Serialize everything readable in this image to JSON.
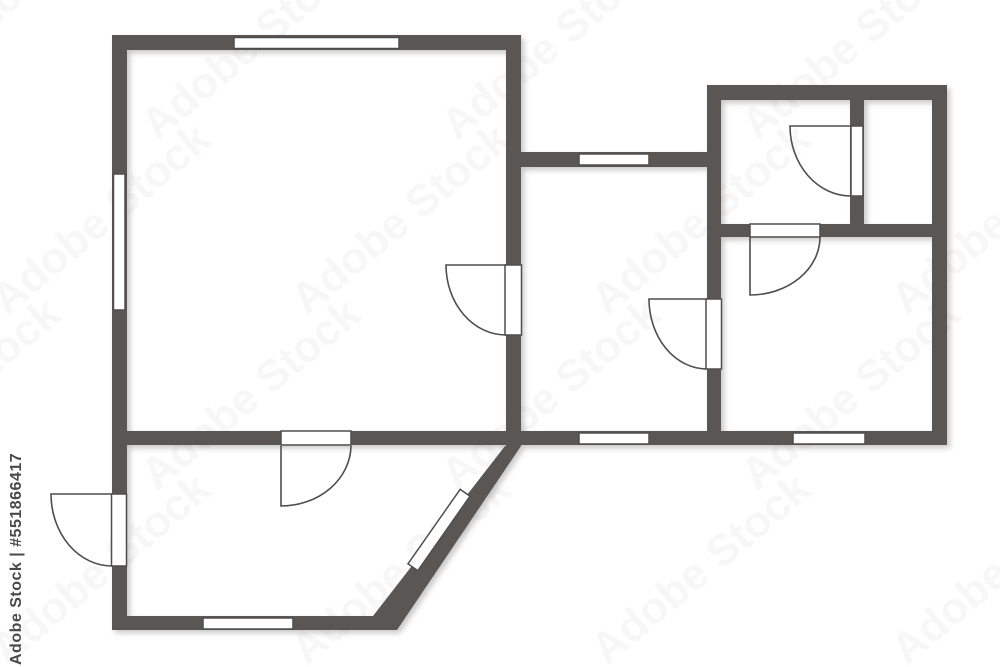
{
  "watermark": {
    "label": "Adobe Stock | #551866417",
    "tile_text": "Adobe Stock",
    "text_color": "#4b4947",
    "tile_color": "#8f8d8b",
    "tile_opacity": 0.06
  },
  "plan": {
    "canvas": {
      "width": 1000,
      "height": 667,
      "background": "#ffffff"
    },
    "wall_color": "#595653",
    "line_color": "#504e4c",
    "window_fill": "#ffffff",
    "walls": [
      {
        "name": "wall-left-exterior",
        "x": 112,
        "y": 35,
        "w": 15,
        "h": 595
      },
      {
        "name": "wall-top-living",
        "x": 112,
        "y": 35,
        "w": 409,
        "h": 15
      },
      {
        "name": "wall-right-living",
        "x": 506,
        "y": 35,
        "w": 15,
        "h": 411
      },
      {
        "name": "wall-bottom-main",
        "x": 112,
        "y": 431,
        "w": 835,
        "h": 14
      },
      {
        "name": "wall-top-middle",
        "x": 521,
        "y": 152,
        "w": 186,
        "h": 15
      },
      {
        "name": "wall-vertical-middle-right",
        "x": 707,
        "y": 85,
        "w": 14,
        "h": 360
      },
      {
        "name": "wall-top-right-block",
        "x": 707,
        "y": 85,
        "w": 240,
        "h": 15
      },
      {
        "name": "wall-right-exterior",
        "x": 932,
        "y": 85,
        "w": 15,
        "h": 360
      },
      {
        "name": "wall-divider-top-rooms",
        "x": 850,
        "y": 100,
        "w": 14,
        "h": 124
      },
      {
        "name": "wall-horizontal-right-block",
        "x": 721,
        "y": 224,
        "w": 211,
        "h": 13
      },
      {
        "name": "wall-bottom-lower-room",
        "x": 112,
        "y": 616,
        "w": 285,
        "h": 14
      }
    ],
    "diagonal_wall": {
      "name": "wall-diagonal",
      "points": "505,446 521,446 397,630 373,616"
    },
    "windows": [
      {
        "name": "window-top-living",
        "x": 234,
        "y": 37.5,
        "w": 165,
        "h": 11
      },
      {
        "name": "window-left-living",
        "x": 113.5,
        "y": 174,
        "w": 11.5,
        "h": 136
      },
      {
        "name": "window-top-middle",
        "x": 579,
        "y": 154,
        "w": 70,
        "h": 11
      },
      {
        "name": "window-bottom-middle",
        "x": 579,
        "y": 433,
        "w": 70,
        "h": 11
      },
      {
        "name": "window-bottom-right-room",
        "x": 793,
        "y": 433,
        "w": 72,
        "h": 11
      },
      {
        "name": "window-bottom-lower-room",
        "x": 203,
        "y": 618,
        "w": 90,
        "h": 11
      }
    ],
    "diagonal_window": {
      "name": "window-diagonal",
      "cx": 439,
      "cy": 530,
      "w": 91,
      "h": 12,
      "angle": 125
    },
    "door_openings": [
      {
        "name": "door-opening-living-right",
        "x": 505,
        "y": 265,
        "w": 16.5,
        "h": 70
      },
      {
        "name": "door-opening-middle-right",
        "x": 706,
        "y": 299,
        "w": 15.5,
        "h": 70
      },
      {
        "name": "door-opening-top-divider",
        "x": 851,
        "y": 126,
        "w": 12,
        "h": 70
      },
      {
        "name": "door-opening-right-block",
        "x": 750,
        "y": 224,
        "w": 70,
        "h": 13
      },
      {
        "name": "door-opening-lower-room",
        "x": 281,
        "y": 431,
        "w": 70,
        "h": 14
      },
      {
        "name": "door-opening-left-exterior",
        "x": 111.5,
        "y": 494,
        "w": 15,
        "h": 72
      }
    ],
    "door_swings": [
      {
        "name": "door-swing-living-right",
        "d": "M506,265 L446,265 A60,70 0 0 0 506,335"
      },
      {
        "name": "door-swing-middle-right",
        "d": "M707,299 L649,299 A58,70 0 0 0 707,369"
      },
      {
        "name": "door-swing-top-divider",
        "d": "M851,126 L790,126 A61,70 0 0 0 851,196"
      },
      {
        "name": "door-swing-right-block",
        "d": "M750,237 L750,295 A70,58 0 0 0 820,237"
      },
      {
        "name": "door-swing-lower-room",
        "d": "M281,446 L281,506 A70,61 0 0 0 351,446"
      },
      {
        "name": "door-swing-left-exterior",
        "d": "M112,494 L51,494 A61,72 0 0 0 112,566"
      }
    ]
  }
}
